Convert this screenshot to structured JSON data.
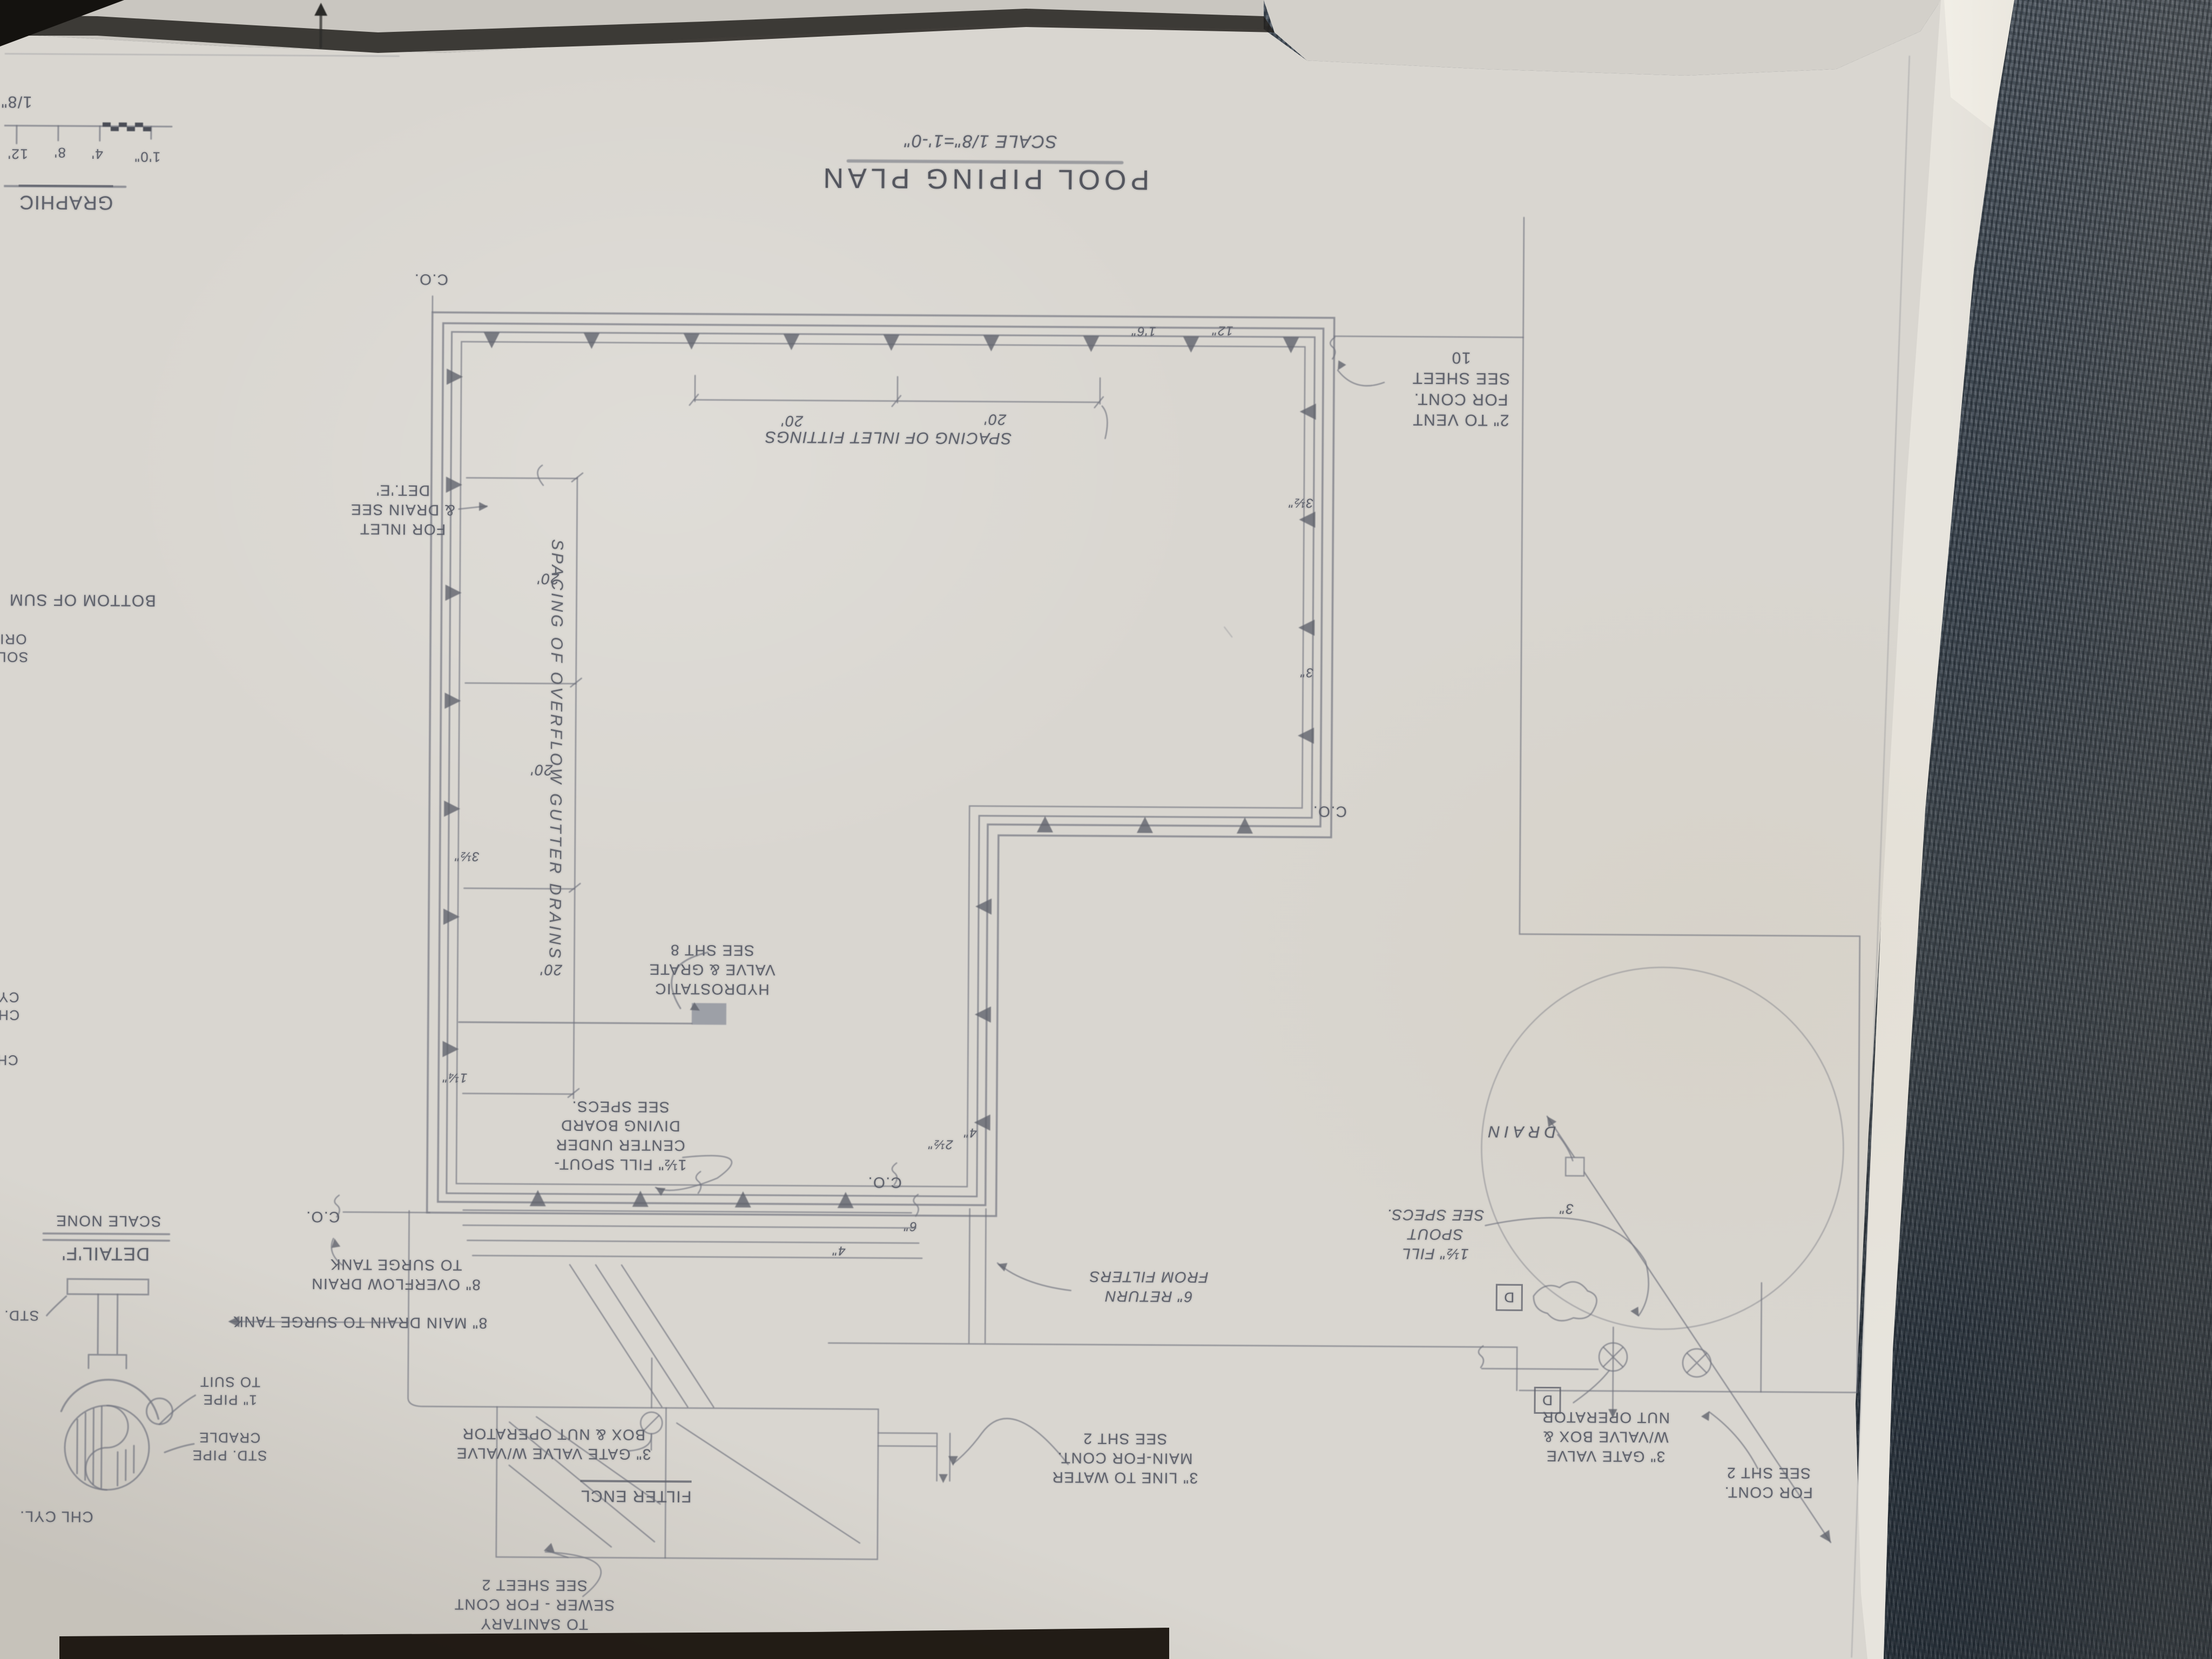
{
  "title_block": {
    "title": "POOL PIPING PLAN",
    "scale": "SCALE 1/8\"=1'-0\""
  },
  "graphic_scale": {
    "caption": "GRAPHIC",
    "fraction": "1/8\"",
    "t12": "12'",
    "t8": "8'",
    "t4": "4'",
    "t10": "1'0\""
  },
  "dims": {
    "twenty": "20'",
    "spacing_inlets": "SPACING OF INLET FITTINGS",
    "spacing_gutters": "SPACING OF OVERFLOW GUTTER DRAINS"
  },
  "notes": {
    "vent": "2\" TO VENT\nFOR CONT.\nSEE SHEET\n10",
    "inlet_detail": "FOR INLET\n& DRAIN SEE\nDET.'E'",
    "hydrostatic": "HYDROSTATIC\nVALVE & GRATE\nSEE SHT 8",
    "fill_spout_diving": "1½\" FILL SPOUT-\nCENTER UNDER\nDIVING BOARD\nSEE SPECS.",
    "overflow_drain": "8\" OVERFLOW DRAIN\nTO SURGE TANK",
    "main_drain": "8\" MAIN DRAIN TO SURGE TANK",
    "gate_valve_left": "3\" GATE VALVE W/VALVE\nBOX & NUT OPERATOR",
    "filter_encl": "FILTER ENCL",
    "sanitary": "TO SANITARY\nSEWER - FOR CONT\nSEE SHEET 2",
    "return_filters": "6\" RETURN\nFROM FILTERS",
    "water_main": "3\" LINE TO WATER\nMAIN-FOR CONT.\nSEE SHT 2",
    "drain": "DRAIN",
    "fill_spout_right": "1½\" FILL\nSPOUT\nSEE SPECS.",
    "gate_valve_right": "3\" GATE VALVE\nW/VALVE BOX &\nNUT OPERATOR",
    "for_cont": "FOR CONT.\nSEE SHT 2",
    "cleanout": "C.O.",
    "detail_marker": "D"
  },
  "sizes": {
    "s16": "1'6\"",
    "s12": "12\"",
    "s35": "3½\"",
    "s3": "3\"",
    "s4": "4\"",
    "s6": "6\"",
    "s25": "2½\"",
    "s125": "1¼\""
  },
  "detail_f": {
    "name": "DETAIL'F'",
    "scale": "SCALE NONE",
    "pipe_note": "1\" PIPE\nTO SUIT",
    "cradle_note": "STD. PIPE\nCRADLE",
    "cylinder": "CHL CYL.",
    "std": "STD."
  },
  "edge_fragments": {
    "bottom_of": "BOTTOM OF SUM",
    "sol": "SOL\nORI",
    "ch_cy": "CH\nCY",
    "ch": "CH"
  },
  "colors": {
    "paper": "#d9d6d0",
    "carpet": "#4a535c",
    "pencil": "#6d717c",
    "ink_dark": "#585b64"
  }
}
